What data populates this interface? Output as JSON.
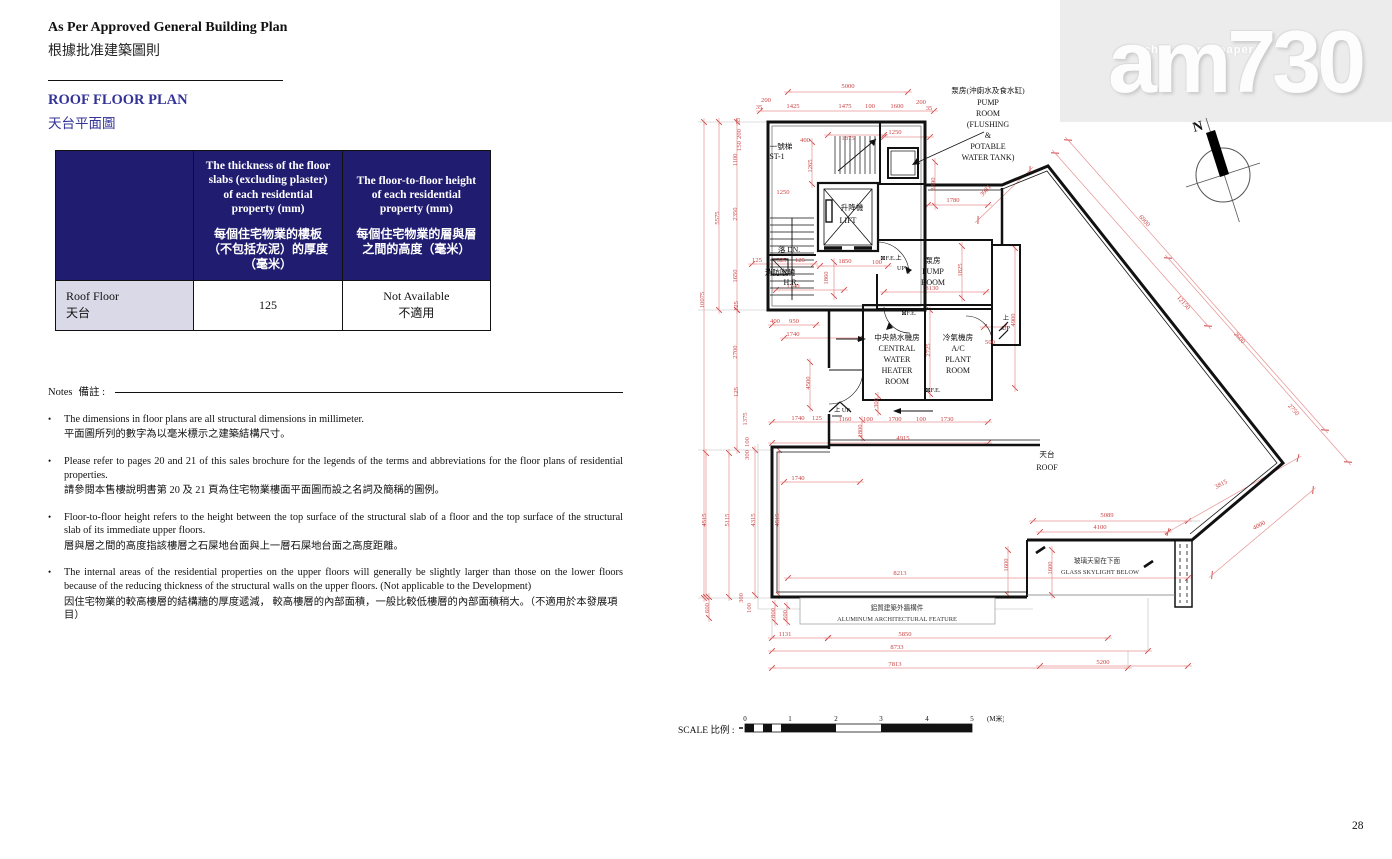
{
  "page": {
    "number": "28"
  },
  "header": {
    "title_en": "As Per Approved General Building Plan",
    "title_zh": "根據批准建築圖則",
    "section_en": "ROOF FLOOR PLAN",
    "section_zh": "天台平面圖"
  },
  "watermark": {
    "tagline": "my choice . my paper",
    "logo": "am730"
  },
  "table": {
    "col_thickness_en": "The thickness of the floor slabs (excluding plaster) of each residential property (mm)",
    "col_thickness_zh": "每個住宅物業的樓板（不包括灰泥）的厚度（毫米）",
    "col_height_en": "The floor-to-floor height of each residential property (mm)",
    "col_height_zh": "每個住宅物業的層與層之間的高度（毫米）",
    "row_label_en": "Roof Floor",
    "row_label_zh": "天台",
    "thickness_value": "125",
    "height_value_en": "Not Available",
    "height_value_zh": "不適用"
  },
  "notes": {
    "label_en": "Notes",
    "label_zh": "備註 :",
    "items": [
      {
        "en": "The dimensions in floor plans are all structural dimensions in millimeter.",
        "zh": "平面圖所列的數字為以毫米標示之建築結構尺寸。"
      },
      {
        "en": "Please refer to pages 20 and 21 of this sales brochure for the legends of the terms and abbreviations for the floor plans of residential properties.",
        "zh": "請參閱本售樓說明書第 20 及 21 頁為住宅物業樓面平面圖而設之名詞及簡稱的圖例。"
      },
      {
        "en": "Floor-to-floor height refers to the height between the top surface of the structural slab of a floor and the top surface of the structural slab of its immediate upper floors.",
        "zh": "層與層之間的高度指該樓層之石屎地台面與上一層石屎地台面之高度距離。"
      },
      {
        "en": "The internal areas of the residential properties on the upper floors will generally be slightly larger than those on the lower floors because of the reducing thickness of the structural walls on the upper floors. (Not applicable to the Development)",
        "zh": "因住宅物業的較高樓層的結構牆的厚度遞減， 較高樓層的內部面積，一般比較低樓層的內部面積稍大。（不適用於本發展項目）"
      }
    ]
  },
  "compass": {
    "north_label": "N"
  },
  "plan": {
    "colors": {
      "dim_line": "#e79191",
      "dim_text": "#cc4444",
      "wall": "#111111",
      "gray": "#b9b9b9"
    },
    "scale": {
      "label": "SCALE 比例 :",
      "ticks": [
        "0",
        "1",
        "2",
        "3",
        "4",
        "5"
      ],
      "unit": "(M米)"
    },
    "labels": [
      {
        "t": "5000",
        "x": 160,
        "y": 10
      },
      {
        "t": "200",
        "x": 78,
        "y": 24
      },
      {
        "t": "35",
        "x": 71,
        "y": 31
      },
      {
        "t": "1425",
        "x": 105,
        "y": 30
      },
      {
        "t": "1475",
        "x": 157,
        "y": 30
      },
      {
        "t": "100",
        "x": 182,
        "y": 30
      },
      {
        "t": "1600",
        "x": 209,
        "y": 30
      },
      {
        "t": "200",
        "x": 233,
        "y": 26
      },
      {
        "t": "35",
        "x": 241,
        "y": 32
      },
      {
        "t": "35",
        "x": 52,
        "y": 43,
        "r": -90
      },
      {
        "t": "200",
        "x": 53,
        "y": 56,
        "r": -90
      },
      {
        "t": "150",
        "x": 53,
        "y": 68,
        "r": -90
      },
      {
        "t": "1100",
        "x": 49,
        "y": 82,
        "r": -90
      },
      {
        "t": "2350",
        "x": 49,
        "y": 136,
        "r": -90
      },
      {
        "t": "1650",
        "x": 49,
        "y": 198,
        "r": -90
      },
      {
        "t": "125",
        "x": 50,
        "y": 228,
        "r": -90
      },
      {
        "t": "5575",
        "x": 31,
        "y": 140,
        "r": -90
      },
      {
        "t": "10075",
        "x": 16,
        "y": 222,
        "r": -90
      },
      {
        "t": "2700",
        "x": 49,
        "y": 274,
        "r": -90
      },
      {
        "t": "125",
        "x": 50,
        "y": 314,
        "r": -90
      },
      {
        "t": "1375",
        "x": 59,
        "y": 341,
        "r": -90
      },
      {
        "t": "100",
        "x": 61,
        "y": 364,
        "r": -90
      },
      {
        "t": "300",
        "x": 61,
        "y": 377,
        "r": -90
      },
      {
        "t": "4515",
        "x": 18,
        "y": 442,
        "r": -90
      },
      {
        "t": "5115",
        "x": 41,
        "y": 442,
        "r": -90
      },
      {
        "t": "4315",
        "x": 67,
        "y": 442,
        "r": -90
      },
      {
        "t": "4515",
        "x": 91,
        "y": 442,
        "r": -90
      },
      {
        "t": "600",
        "x": 21,
        "y": 530,
        "r": -90
      },
      {
        "t": "300",
        "x": 55,
        "y": 520,
        "r": -90
      },
      {
        "t": "100",
        "x": 63,
        "y": 530,
        "r": -90
      },
      {
        "t": "800",
        "x": 87,
        "y": 535,
        "r": -90
      },
      {
        "t": "500",
        "x": 99,
        "y": 537,
        "r": -90
      },
      {
        "t": "1131",
        "x": 97,
        "y": 558
      },
      {
        "t": "5850",
        "x": 217,
        "y": 558
      },
      {
        "t": "8733",
        "x": 209,
        "y": 571
      },
      {
        "t": "7813",
        "x": 207,
        "y": 588
      },
      {
        "t": "8213",
        "x": 212,
        "y": 497
      },
      {
        "t": "5200",
        "x": 415,
        "y": 586
      },
      {
        "t": "1740",
        "x": 110,
        "y": 342
      },
      {
        "t": "125",
        "x": 129,
        "y": 342
      },
      {
        "t": "1160",
        "x": 157,
        "y": 343
      },
      {
        "t": "100",
        "x": 180,
        "y": 343
      },
      {
        "t": "1700",
        "x": 207,
        "y": 343
      },
      {
        "t": "100",
        "x": 233,
        "y": 343
      },
      {
        "t": "1730",
        "x": 259,
        "y": 343
      },
      {
        "t": "1800",
        "x": 174,
        "y": 353,
        "r": -90
      },
      {
        "t": "300",
        "x": 190,
        "y": 325,
        "r": -90
      },
      {
        "t": "4915",
        "x": 215,
        "y": 362
      },
      {
        "t": "1740",
        "x": 110,
        "y": 402
      },
      {
        "t": "1740",
        "x": 105,
        "y": 258
      },
      {
        "t": "400",
        "x": 87,
        "y": 245
      },
      {
        "t": "950",
        "x": 106,
        "y": 245
      },
      {
        "t": "4500",
        "x": 122,
        "y": 305,
        "r": -90
      },
      {
        "t": "1600",
        "x": 320,
        "y": 487,
        "r": -90
      },
      {
        "t": "1600",
        "x": 364,
        "y": 490,
        "r": -90
      },
      {
        "t": "5089",
        "x": 419,
        "y": 439
      },
      {
        "t": "4100",
        "x": 412,
        "y": 451
      },
      {
        "t": "400",
        "x": 117,
        "y": 64
      },
      {
        "t": "1265",
        "x": 124,
        "y": 88,
        "r": -90
      },
      {
        "t": "1250",
        "x": 95,
        "y": 116
      },
      {
        "t": "1875",
        "x": 160,
        "y": 62
      },
      {
        "t": "1250",
        "x": 207,
        "y": 56
      },
      {
        "t": "1325",
        "x": 92,
        "y": 184
      },
      {
        "t": "125",
        "x": 69,
        "y": 184
      },
      {
        "t": "125",
        "x": 112,
        "y": 184
      },
      {
        "t": "1740",
        "x": 105,
        "y": 210
      },
      {
        "t": "1850",
        "x": 157,
        "y": 185
      },
      {
        "t": "100",
        "x": 189,
        "y": 186
      },
      {
        "t": "1860",
        "x": 140,
        "y": 200,
        "r": -90
      },
      {
        "t": "3390",
        "x": 247,
        "y": 106,
        "r": -90
      },
      {
        "t": "1780",
        "x": 265,
        "y": 124
      },
      {
        "t": "3981",
        "x": 299,
        "y": 114,
        "r": -48
      },
      {
        "t": "1825",
        "x": 274,
        "y": 192,
        "r": -90
      },
      {
        "t": "3130",
        "x": 244,
        "y": 212
      },
      {
        "t": "2725",
        "x": 242,
        "y": 272,
        "r": -90
      },
      {
        "t": "500",
        "x": 302,
        "y": 266
      },
      {
        "t": "4900",
        "x": 327,
        "y": 242,
        "r": -90
      },
      {
        "t": "6900",
        "x": 455,
        "y": 144,
        "r": 48
      },
      {
        "t": "12150",
        "x": 494,
        "y": 226,
        "r": 48
      },
      {
        "t": "2600",
        "x": 550,
        "y": 261,
        "r": 48
      },
      {
        "t": "2750",
        "x": 604,
        "y": 333,
        "r": 48
      },
      {
        "t": "3815",
        "x": 534,
        "y": 408,
        "r": -28
      },
      {
        "t": "4000",
        "x": 572,
        "y": 449,
        "r": -28
      },
      {
        "t": "一號梯",
        "x": 93,
        "y": 71,
        "c": "z"
      },
      {
        "t": "ST-1",
        "x": 89,
        "y": 81,
        "c": "r"
      },
      {
        "t": "升降機",
        "x": 164,
        "y": 132,
        "c": "z"
      },
      {
        "t": "LIFT",
        "x": 160,
        "y": 145,
        "c": "r"
      },
      {
        "t": "落 DN.",
        "x": 101,
        "y": 174,
        "c": "z"
      },
      {
        "t": "消防喉轆",
        "x": 92,
        "y": 197,
        "c": "z"
      },
      {
        "t": "H.R.",
        "x": 103,
        "y": 207,
        "c": "r"
      },
      {
        "t": "泵房(沖廁水及食水缸)",
        "x": 300,
        "y": 15,
        "c": "z"
      },
      {
        "t": "PUMP",
        "x": 300,
        "y": 27,
        "c": "r"
      },
      {
        "t": "ROOM",
        "x": 300,
        "y": 38,
        "c": "r"
      },
      {
        "t": "(FLUSHING",
        "x": 300,
        "y": 49,
        "c": "r"
      },
      {
        "t": "&",
        "x": 300,
        "y": 60,
        "c": "r"
      },
      {
        "t": "POTABLE",
        "x": 300,
        "y": 71,
        "c": "r"
      },
      {
        "t": "WATER TANK)",
        "x": 300,
        "y": 82,
        "c": "r"
      },
      {
        "t": "泵房",
        "x": 245,
        "y": 185,
        "c": "z"
      },
      {
        "t": "PUMP",
        "x": 245,
        "y": 196,
        "c": "r"
      },
      {
        "t": "ROOM",
        "x": 245,
        "y": 207,
        "c": "r"
      },
      {
        "t": "中央熱水機房",
        "x": 209,
        "y": 262,
        "c": "z"
      },
      {
        "t": "CENTRAL",
        "x": 209,
        "y": 273,
        "c": "r"
      },
      {
        "t": "WATER",
        "x": 209,
        "y": 284,
        "c": "r"
      },
      {
        "t": "HEATER",
        "x": 209,
        "y": 295,
        "c": "r"
      },
      {
        "t": "ROOM",
        "x": 209,
        "y": 306,
        "c": "r"
      },
      {
        "t": "冷氣機房",
        "x": 270,
        "y": 262,
        "c": "z"
      },
      {
        "t": "A/C",
        "x": 270,
        "y": 273,
        "c": "r"
      },
      {
        "t": "PLANT",
        "x": 270,
        "y": 284,
        "c": "r"
      },
      {
        "t": "ROOM",
        "x": 270,
        "y": 295,
        "c": "r"
      },
      {
        "t": "天台",
        "x": 359,
        "y": 379,
        "c": "z"
      },
      {
        "t": "ROOF",
        "x": 359,
        "y": 392,
        "c": "r"
      },
      {
        "t": "玻璃天窗在下面",
        "x": 409,
        "y": 485,
        "c": "zs"
      },
      {
        "t": "GLASS SKYLIGHT BELOW",
        "x": 412,
        "y": 496,
        "c": "rs"
      },
      {
        "t": "鋁質建築外牆構件",
        "x": 209,
        "y": 532,
        "c": "zs"
      },
      {
        "t": "ALUMINUM ARCHITECTURAL FEATURE",
        "x": 209,
        "y": 543,
        "c": "rs"
      },
      {
        "t": "⊠F.E.上",
        "x": 203,
        "y": 182,
        "c": "s"
      },
      {
        "t": "UP",
        "x": 213,
        "y": 192,
        "c": "s"
      },
      {
        "t": "⊠F.E.",
        "x": 221,
        "y": 237,
        "c": "s"
      },
      {
        "t": "⊠F.E.",
        "x": 245,
        "y": 314,
        "c": "s"
      },
      {
        "t": "上",
        "x": 318,
        "y": 242,
        "c": "s"
      },
      {
        "t": "UP",
        "x": 318,
        "y": 252,
        "c": "s"
      },
      {
        "t": "上 UP",
        "x": 154,
        "y": 334,
        "c": "s"
      }
    ],
    "dim_lines": [
      [
        100,
        14,
        220,
        14
      ],
      [
        72,
        33,
        246,
        33
      ],
      [
        16,
        44,
        16,
        520
      ],
      [
        31,
        44,
        31,
        232
      ],
      [
        49,
        44,
        49,
        232
      ],
      [
        49,
        232,
        49,
        372
      ],
      [
        64,
        186,
        126,
        186
      ],
      [
        88,
        212,
        156,
        212
      ],
      [
        84,
        247,
        128,
        247
      ],
      [
        96,
        260,
        172,
        260
      ],
      [
        140,
        57,
        196,
        57
      ],
      [
        196,
        59,
        242,
        59
      ],
      [
        132,
        188,
        200,
        188
      ],
      [
        240,
        127,
        300,
        127
      ],
      [
        196,
        214,
        298,
        214
      ],
      [
        247,
        84,
        247,
        128
      ],
      [
        274,
        168,
        274,
        220
      ],
      [
        242,
        232,
        242,
        316
      ],
      [
        327,
        170,
        327,
        310
      ],
      [
        124,
        64,
        124,
        106
      ],
      [
        122,
        284,
        122,
        330
      ],
      [
        146,
        184,
        146,
        218
      ],
      [
        190,
        318,
        190,
        334
      ],
      [
        174,
        342,
        174,
        360
      ],
      [
        84,
        344,
        300,
        344
      ],
      [
        84,
        365,
        300,
        365
      ],
      [
        96,
        404,
        172,
        404
      ],
      [
        18,
        375,
        18,
        519
      ],
      [
        41,
        375,
        41,
        519
      ],
      [
        67,
        372,
        67,
        517
      ],
      [
        91,
        372,
        91,
        517
      ],
      [
        100,
        500,
        500,
        500
      ],
      [
        21,
        519,
        21,
        540
      ],
      [
        87,
        526,
        87,
        544
      ],
      [
        99,
        528,
        99,
        544
      ],
      [
        84,
        560,
        140,
        560
      ],
      [
        140,
        560,
        420,
        560
      ],
      [
        84,
        573,
        460,
        573
      ],
      [
        84,
        590,
        440,
        590
      ],
      [
        352,
        588,
        500,
        588
      ],
      [
        345,
        443,
        500,
        443
      ],
      [
        352,
        454,
        480,
        454
      ],
      [
        320,
        472,
        320,
        517
      ],
      [
        364,
        472,
        364,
        517
      ],
      [
        296,
        249,
        316,
        249
      ],
      [
        367,
        75,
        520,
        248
      ],
      [
        380,
        62,
        637,
        352
      ],
      [
        480,
        180,
        660,
        384
      ],
      [
        610,
        380,
        480,
        454
      ],
      [
        625,
        412,
        524,
        497
      ],
      [
        290,
        142,
        342,
        92
      ]
    ],
    "gray_lines": [
      [
        10,
        44,
        80,
        44
      ],
      [
        10,
        232,
        80,
        232
      ],
      [
        10,
        372,
        84,
        372
      ],
      [
        10,
        520,
        84,
        520
      ],
      [
        84,
        540,
        84,
        560
      ],
      [
        460,
        520,
        460,
        573
      ],
      [
        440,
        573,
        440,
        590
      ],
      [
        500,
        443,
        512,
        443
      ],
      [
        70,
        366,
        70,
        531
      ],
      [
        70,
        531,
        345,
        531
      ]
    ]
  }
}
